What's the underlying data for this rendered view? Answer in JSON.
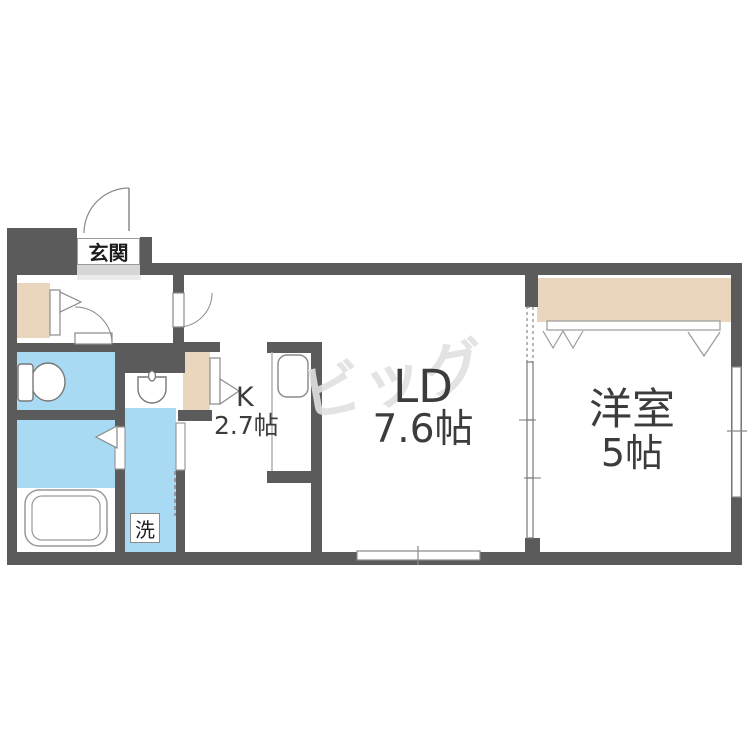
{
  "floorplan": {
    "watermark": "ビッグ",
    "entrance": {
      "label": "玄関"
    },
    "kitchen": {
      "label": "K",
      "size": "2.7帖"
    },
    "living_dining": {
      "label": "LD",
      "size": "7.6帖"
    },
    "western_room": {
      "label": "洋室",
      "size": "5帖"
    },
    "laundry": {
      "label": "洗"
    },
    "colors": {
      "wall": "#5b5b5b",
      "water_area_blue": "#a9daf3",
      "closet_beige": "#e9d6bd",
      "entrance_step_gray": "#d6d6d6",
      "label_text": "#3c3c3c",
      "watermark_gray": "#e1e1e1"
    }
  }
}
